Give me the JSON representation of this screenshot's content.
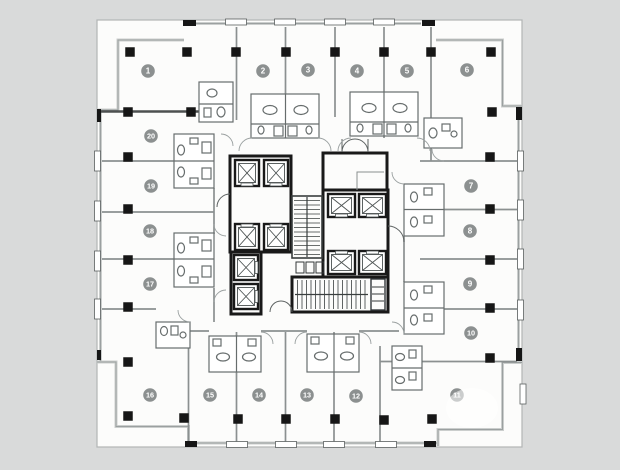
{
  "page": {
    "background": "#d9dada"
  },
  "plan": {
    "description": "Residential tower typical floor plan: 20 numbered units arranged around a central elevator and stair core",
    "colors": {
      "paper": "#fcfcfb",
      "outline": "#b2b5b5",
      "glass_band": "#cbcecd",
      "glass_line": "#9ba0a0",
      "partition": "#8b9090",
      "dark_wall": "#161616",
      "pod_stroke": "#676d6d",
      "core_wall": "#191919",
      "column": "#161616",
      "badge_fill": "#8c9090",
      "badge_text": "#ffffff",
      "mullion_fill": "#ffffff",
      "mullion_stroke": "#5a5f5f"
    },
    "units": [
      {
        "label": "1",
        "x": 148,
        "y": 71
      },
      {
        "label": "2",
        "x": 263,
        "y": 71
      },
      {
        "label": "3",
        "x": 308,
        "y": 70
      },
      {
        "label": "4",
        "x": 357,
        "y": 71
      },
      {
        "label": "5",
        "x": 407,
        "y": 71
      },
      {
        "label": "6",
        "x": 467,
        "y": 70
      },
      {
        "label": "7",
        "x": 471,
        "y": 186
      },
      {
        "label": "8",
        "x": 470,
        "y": 231
      },
      {
        "label": "9",
        "x": 470,
        "y": 284
      },
      {
        "label": "10",
        "x": 471,
        "y": 333
      },
      {
        "label": "11",
        "x": 457,
        "y": 395
      },
      {
        "label": "12",
        "x": 356,
        "y": 396
      },
      {
        "label": "13",
        "x": 307,
        "y": 395
      },
      {
        "label": "14",
        "x": 259,
        "y": 395
      },
      {
        "label": "15",
        "x": 210,
        "y": 395
      },
      {
        "label": "16",
        "x": 150,
        "y": 395
      },
      {
        "label": "17",
        "x": 150,
        "y": 284
      },
      {
        "label": "18",
        "x": 150,
        "y": 231
      },
      {
        "label": "19",
        "x": 151,
        "y": 186
      },
      {
        "label": "20",
        "x": 151,
        "y": 136
      }
    ],
    "columns": {
      "size": 9.5,
      "points": [
        [
          130,
          52
        ],
        [
          187,
          52
        ],
        [
          236,
          52
        ],
        [
          286,
          52
        ],
        [
          335,
          52
        ],
        [
          384,
          52
        ],
        [
          431,
          52
        ],
        [
          491,
          52
        ],
        [
          128,
          112
        ],
        [
          191,
          112
        ],
        [
          492,
          112
        ],
        [
          128,
          157
        ],
        [
          128,
          209
        ],
        [
          128,
          260
        ],
        [
          128,
          307
        ],
        [
          128,
          362
        ],
        [
          490,
          157
        ],
        [
          490,
          209
        ],
        [
          490,
          260
        ],
        [
          490,
          308
        ],
        [
          490,
          358
        ],
        [
          128,
          416
        ],
        [
          184,
          418
        ],
        [
          238,
          419
        ],
        [
          286,
          419
        ],
        [
          335,
          419
        ],
        [
          384,
          420
        ],
        [
          432,
          419
        ]
      ]
    },
    "mullions": {
      "top_xs": [
        236,
        285,
        335,
        384
      ],
      "bottom_xs": [
        237,
        286,
        334,
        386
      ],
      "left_ys": [
        161,
        211,
        261,
        309
      ],
      "right_ys": [
        161,
        210,
        259,
        310
      ],
      "extra_right": [
        {
          "x": 520,
          "y": 384
        }
      ]
    },
    "elevators": [
      [
        235,
        160,
        24,
        26,
        "S"
      ],
      [
        264,
        160,
        24,
        26,
        "S"
      ],
      [
        235,
        224,
        24,
        26,
        "N"
      ],
      [
        264,
        224,
        24,
        26,
        "N"
      ],
      [
        234,
        255,
        24,
        25,
        "E"
      ],
      [
        234,
        284,
        24,
        25,
        "E"
      ],
      [
        328,
        194,
        27,
        23,
        "S"
      ],
      [
        359,
        194,
        27,
        23,
        "S"
      ],
      [
        328,
        251,
        27,
        23,
        "N"
      ],
      [
        359,
        251,
        27,
        23,
        "N"
      ]
    ],
    "door_arcs": [
      "M221,134 A12,12 0 0 1 233,146",
      "M239,151 A13,13 0 0 1 252,138",
      "M318,138 A13,13 0 0 1 331,151",
      "M338,151 A13,13 0 0 1 351,138",
      "M417,138 A13,13 0 0 1 430,151",
      "M432,149 A12,12 0 0 0 444,161",
      "M214,224 A12,12 0 0 0 226,236",
      "M214,302 A12,12 0 0 1 226,290",
      "M178,310 A12,12 0 0 0 190,322",
      "M273,344 A12,12 0 0 0 261,332",
      "M295,344 A12,12 0 0 1 307,332",
      "M371,344 A12,12 0 0 0 359,332",
      "M392,172 A12,12 0 0 0 404,184",
      "M392,322 A12,12 0 0 1 404,334"
    ]
  }
}
